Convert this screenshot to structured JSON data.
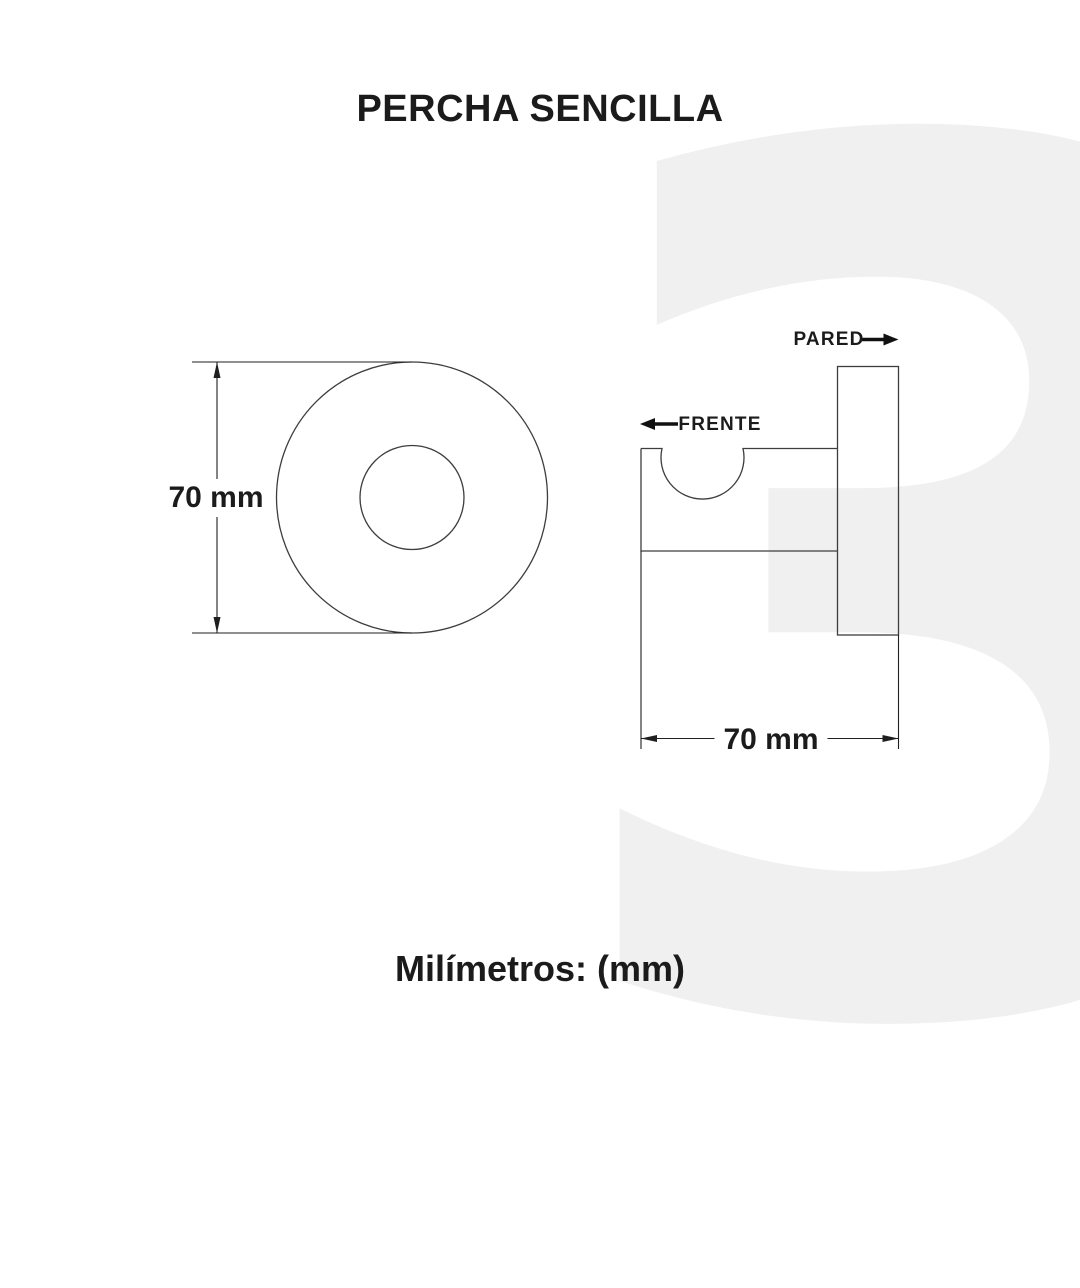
{
  "page": {
    "title": "PERCHA SENCILLA",
    "units_note": "Milímetros: (mm)",
    "watermark_digit": "3"
  },
  "colors": {
    "background": "#ffffff",
    "text": "#1b1b1b",
    "drawing_line": "#3d3d3d",
    "dimension_line": "#1f1f1f",
    "watermark": "#f0f0f1"
  },
  "front_view": {
    "dimension": {
      "label": "70 mm",
      "value": 70,
      "unit": "mm",
      "orientation": "vertical"
    }
  },
  "side_view": {
    "dimension": {
      "label": "70 mm",
      "value": 70,
      "unit": "mm",
      "orientation": "horizontal"
    },
    "wall_label": "PARED",
    "front_label": "FRENTE"
  }
}
